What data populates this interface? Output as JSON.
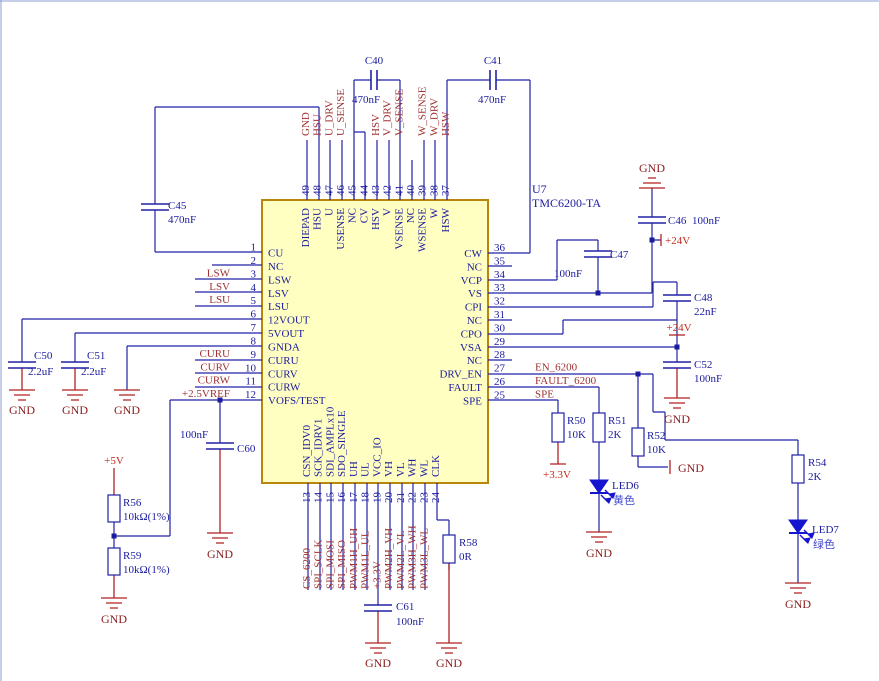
{
  "schematic": {
    "ic": {
      "ref": "U7",
      "part": "TMC6200-TA",
      "pins": {
        "left": [
          {
            "num": "1",
            "name": "CU",
            "net": ""
          },
          {
            "num": "2",
            "name": "NC",
            "net": ""
          },
          {
            "num": "3",
            "name": "LSW",
            "net": "LSW"
          },
          {
            "num": "4",
            "name": "LSV",
            "net": "LSV"
          },
          {
            "num": "5",
            "name": "LSU",
            "net": "LSU"
          },
          {
            "num": "6",
            "name": "12VOUT",
            "net": ""
          },
          {
            "num": "7",
            "name": "5VOUT",
            "net": ""
          },
          {
            "num": "8",
            "name": "GNDA",
            "net": ""
          },
          {
            "num": "9",
            "name": "CURU",
            "net": "CURU"
          },
          {
            "num": "10",
            "name": "CURV",
            "net": "CURV"
          },
          {
            "num": "11",
            "name": "CURW",
            "net": "CURW"
          },
          {
            "num": "12",
            "name": "VOFS/TEST",
            "net": "+2.5VREF"
          }
        ],
        "top": [
          {
            "num": "49",
            "name": "DIEPAD",
            "net": "GND"
          },
          {
            "num": "48",
            "name": "HSU",
            "net": "HSU"
          },
          {
            "num": "47",
            "name": "U",
            "net": "U_DRV"
          },
          {
            "num": "46",
            "name": "USENSE",
            "net": "U_SENSE"
          },
          {
            "num": "45",
            "name": "NC",
            "net": ""
          },
          {
            "num": "44",
            "name": "CV",
            "net": ""
          },
          {
            "num": "43",
            "name": "HSV",
            "net": "HSV"
          },
          {
            "num": "42",
            "name": "V",
            "net": "V_DRV"
          },
          {
            "num": "41",
            "name": "VSENSE",
            "net": "V_SENSE"
          },
          {
            "num": "40",
            "name": "NC",
            "net": ""
          },
          {
            "num": "39",
            "name": "WSENSE",
            "net": "W_SENSE"
          },
          {
            "num": "38",
            "name": "W",
            "net": "W_DRV"
          },
          {
            "num": "37",
            "name": "HSW",
            "net": "HSW"
          }
        ],
        "right": [
          {
            "num": "36",
            "name": "CW",
            "net": ""
          },
          {
            "num": "35",
            "name": "NC",
            "net": ""
          },
          {
            "num": "34",
            "name": "VCP",
            "net": ""
          },
          {
            "num": "33",
            "name": "VS",
            "net": ""
          },
          {
            "num": "32",
            "name": "CPI",
            "net": ""
          },
          {
            "num": "31",
            "name": "NC",
            "net": ""
          },
          {
            "num": "30",
            "name": "CPO",
            "net": ""
          },
          {
            "num": "29",
            "name": "VSA",
            "net": ""
          },
          {
            "num": "28",
            "name": "NC",
            "net": ""
          },
          {
            "num": "27",
            "name": "DRV_EN",
            "net": "EN_6200"
          },
          {
            "num": "26",
            "name": "FAULT",
            "net": "FAULT_6200"
          },
          {
            "num": "25",
            "name": "SPE",
            "net": "SPE"
          }
        ],
        "bottom": [
          {
            "num": "13",
            "name": "CSN_IDV0",
            "net": "CS_6200"
          },
          {
            "num": "14",
            "name": "SCK_IDRV1",
            "net": "SPI_SCLK"
          },
          {
            "num": "15",
            "name": "SDI_AMPLx10",
            "net": "SPI_MOSI"
          },
          {
            "num": "16",
            "name": "SDO_SINGLE",
            "net": "SPI_MISO"
          },
          {
            "num": "17",
            "name": "UH",
            "net": "PWM1H_UH"
          },
          {
            "num": "18",
            "name": "UL",
            "net": "PWM1L_UL"
          },
          {
            "num": "19",
            "name": "VCC_IO",
            "net": "+3.3V"
          },
          {
            "num": "20",
            "name": "VH",
            "net": "PWM2H_VH"
          },
          {
            "num": "21",
            "name": "VL",
            "net": "PWM2L_VL"
          },
          {
            "num": "22",
            "name": "WH",
            "net": "PWM3H_WH"
          },
          {
            "num": "23",
            "name": "WL",
            "net": "PWM3L_WL"
          },
          {
            "num": "24",
            "name": "CLK",
            "net": ""
          }
        ]
      }
    },
    "components": {
      "C40": {
        "ref": "C40",
        "value": "470nF"
      },
      "C41": {
        "ref": "C41",
        "value": "470nF"
      },
      "C45": {
        "ref": "C45",
        "value": "470nF"
      },
      "C46": {
        "ref": "C46",
        "value": "100nF"
      },
      "C47": {
        "ref": "C47",
        "value": "100nF"
      },
      "C48": {
        "ref": "C48",
        "value": "22nF"
      },
      "C50": {
        "ref": "C50",
        "value": "2.2uF"
      },
      "C51": {
        "ref": "C51",
        "value": "2.2uF"
      },
      "C52": {
        "ref": "C52",
        "value": "100nF"
      },
      "C60": {
        "ref": "C60",
        "value": "100nF"
      },
      "C61": {
        "ref": "C61",
        "value": "100nF"
      },
      "R50": {
        "ref": "R50",
        "value": "10K"
      },
      "R51": {
        "ref": "R51",
        "value": "2K"
      },
      "R52": {
        "ref": "R52",
        "value": "10K"
      },
      "R54": {
        "ref": "R54",
        "value": "2K"
      },
      "R56": {
        "ref": "R56",
        "value": "10kΩ(1%)"
      },
      "R58": {
        "ref": "R58",
        "value": "0R"
      },
      "R59": {
        "ref": "R59",
        "value": "10kΩ(1%)"
      },
      "LED6": {
        "ref": "LED6",
        "color_label": "黄色"
      },
      "LED7": {
        "ref": "LED7",
        "color_label": "绿色"
      }
    },
    "power": {
      "p24v": "+24V",
      "p5v": "+5V",
      "p3v3": "+3.3V",
      "gnd": "GND"
    }
  }
}
